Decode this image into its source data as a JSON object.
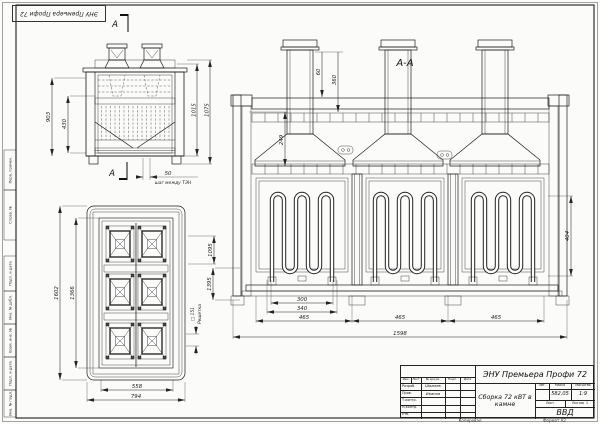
{
  "sheet": {
    "stamp_top_left": "ЭНУ Премьера Профи 72",
    "side_labels": [
      "Перв. примен.",
      "Справ. №",
      "Подп. и дата",
      "Инв. № дубл.",
      "Взам. инв. №",
      "Подп. и дата",
      "Инв. № подл."
    ],
    "footer": {
      "copy": "Копировал",
      "format": "Формат А2"
    }
  },
  "views": {
    "front": {
      "section_letter": "А",
      "dims": {
        "height_outer": "1075",
        "height_inner": "1015",
        "left_outer": "903",
        "left_inner": "430",
        "step": "50"
      },
      "step_note": "шаг между ТЭН"
    },
    "plan": {
      "dims": {
        "outer_height": "1602",
        "inner_height": "1366",
        "inner_width": "558",
        "outer_width": "794",
        "right": "1095",
        "grate_size": "□ 151"
      },
      "grate_label": "Решетка"
    },
    "section": {
      "title": "А-А",
      "dims": {
        "top_small": "60",
        "top_big": "360",
        "stack_height": "249",
        "left": "1395",
        "chamber_height": "404",
        "opening": "300",
        "mid": "340",
        "pitch": "465",
        "total": "1598"
      }
    }
  },
  "title_block": {
    "product": "ЭНУ Премьера Профи 72",
    "doc_title": "Сборка 72 кВТ в камне",
    "lit_label": "Лит.",
    "mass_label": "Масса",
    "scale_label": "Масштаб",
    "mass_value": "582,05",
    "scale_value": "1:9",
    "sheet_label": "Лист",
    "sheets_label": "Листов",
    "sheets_value": "1",
    "org": "ВВД",
    "header_cols": [
      "Изм.",
      "Лист",
      "№ докум.",
      "Подп.",
      "Дата"
    ],
    "rows": [
      {
        "label": "Разраб.",
        "name": "Швалев"
      },
      {
        "label": "Пров.",
        "name": "Иванов"
      },
      {
        "label": "Т.контр.",
        "name": ""
      },
      {
        "label": "Н.контр.",
        "name": ""
      },
      {
        "label": "Утв.",
        "name": ""
      }
    ]
  }
}
